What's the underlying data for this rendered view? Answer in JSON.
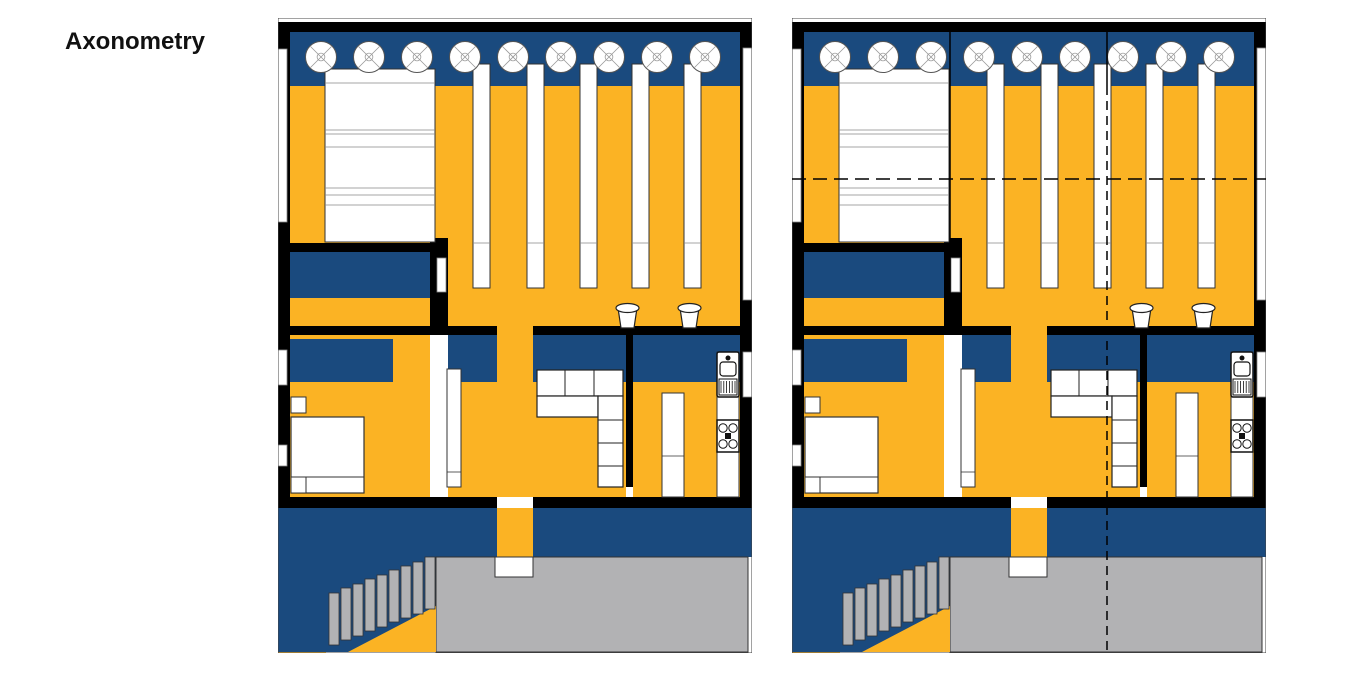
{
  "title": "Axonometry",
  "colors": {
    "navy": "#1A4A7E",
    "yellow": "#FBB324",
    "gray": "#B2B2B4",
    "black": "#000000",
    "white": "#FFFFFF"
  },
  "canvas": {
    "width": 1360,
    "height": 680
  },
  "plan_size": {
    "w": 474,
    "h": 635
  },
  "plans": [
    {
      "id": "floor-plan-left",
      "x": 278,
      "y": 18,
      "overlays": false
    },
    {
      "id": "floor-plan-right",
      "x": 792,
      "y": 18,
      "overlays": true
    }
  ],
  "plan_elements": [
    {
      "name": "hall-floor",
      "kind": "rect",
      "x": 12,
      "y": 68,
      "w": 450,
      "h": 240,
      "fill": "yellow"
    },
    {
      "name": "bedroom-floor",
      "kind": "rect",
      "x": 12,
      "y": 280,
      "w": 140,
      "h": 199,
      "fill": "yellow"
    },
    {
      "name": "living-floor",
      "kind": "rect",
      "x": 170,
      "y": 364,
      "w": 178,
      "h": 115,
      "fill": "yellow"
    },
    {
      "name": "kitchen-floor",
      "kind": "rect",
      "x": 355,
      "y": 364,
      "w": 107,
      "h": 115,
      "fill": "yellow"
    },
    {
      "name": "court-floor",
      "kind": "rect",
      "x": 0,
      "y": 577,
      "w": 48,
      "h": 58,
      "fill": "yellow"
    },
    {
      "name": "gallery-band",
      "kind": "rect",
      "x": 12,
      "y": 14,
      "w": 452,
      "h": 54,
      "fill": "navy"
    },
    {
      "name": "wardrobe-unit",
      "kind": "rect",
      "x": 12,
      "y": 234,
      "w": 145,
      "h": 46,
      "fill": "navy"
    },
    {
      "name": "bedhead-band",
      "kind": "rect",
      "x": 12,
      "y": 321,
      "w": 103,
      "h": 43,
      "fill": "navy"
    },
    {
      "name": "hall-band-left",
      "kind": "rect",
      "x": 170,
      "y": 317,
      "w": 49,
      "h": 47,
      "fill": "navy"
    },
    {
      "name": "hall-band-right",
      "kind": "rect",
      "x": 255,
      "y": 317,
      "w": 93,
      "h": 47,
      "fill": "navy"
    },
    {
      "name": "kitchen-band",
      "kind": "rect",
      "x": 355,
      "y": 317,
      "w": 107,
      "h": 47,
      "fill": "navy"
    },
    {
      "name": "lower-band",
      "kind": "rect",
      "x": 0,
      "y": 490,
      "w": 474,
      "h": 49,
      "fill": "navy"
    },
    {
      "name": "stair-zone",
      "kind": "rect",
      "x": 0,
      "y": 539,
      "w": 158,
      "h": 95,
      "fill": "navy"
    },
    {
      "name": "terrace-slab",
      "kind": "rect",
      "x": 158,
      "y": 539,
      "w": 312,
      "h": 95,
      "fill": "gray",
      "stroke": "#333333",
      "sw": 1
    },
    {
      "name": "corridor-floor",
      "kind": "rect",
      "x": 219,
      "y": 270,
      "w": 36,
      "h": 209,
      "fill": "yellow"
    },
    {
      "name": "corridor-lower",
      "kind": "rect",
      "x": 219,
      "y": 490,
      "w": 36,
      "h": 49,
      "fill": "yellow"
    },
    {
      "name": "under-stair-wedge",
      "kind": "polygon",
      "pts": [
        [
          70,
          634
        ],
        [
          158,
          634
        ],
        [
          158,
          588
        ]
      ],
      "fill": "yellow"
    },
    {
      "name": "stair-step",
      "kind": "rect",
      "x": 51,
      "y": 575,
      "w": 10,
      "h": 52,
      "fill": "gray",
      "stroke": "#333333",
      "sw": 0.8
    },
    {
      "name": "stair-step",
      "kind": "rect",
      "x": 63,
      "y": 570,
      "w": 10,
      "h": 52,
      "fill": "gray",
      "stroke": "#333333",
      "sw": 0.8
    },
    {
      "name": "stair-step",
      "kind": "rect",
      "x": 75,
      "y": 566,
      "w": 10,
      "h": 52,
      "fill": "gray",
      "stroke": "#333333",
      "sw": 0.8
    },
    {
      "name": "stair-step",
      "kind": "rect",
      "x": 87,
      "y": 561,
      "w": 10,
      "h": 52,
      "fill": "gray",
      "stroke": "#333333",
      "sw": 0.8
    },
    {
      "name": "stair-step",
      "kind": "rect",
      "x": 99,
      "y": 557,
      "w": 10,
      "h": 52,
      "fill": "gray",
      "stroke": "#333333",
      "sw": 0.8
    },
    {
      "name": "stair-step",
      "kind": "rect",
      "x": 111,
      "y": 552,
      "w": 10,
      "h": 52,
      "fill": "gray",
      "stroke": "#333333",
      "sw": 0.8
    },
    {
      "name": "stair-step",
      "kind": "rect",
      "x": 123,
      "y": 548,
      "w": 10,
      "h": 52,
      "fill": "gray",
      "stroke": "#333333",
      "sw": 0.8
    },
    {
      "name": "stair-step",
      "kind": "rect",
      "x": 135,
      "y": 544,
      "w": 10,
      "h": 52,
      "fill": "gray",
      "stroke": "#333333",
      "sw": 0.8
    },
    {
      "name": "stair-step",
      "kind": "rect",
      "x": 147,
      "y": 539,
      "w": 10,
      "h": 52,
      "fill": "gray",
      "stroke": "#333333",
      "sw": 0.8
    },
    {
      "name": "top-wall",
      "kind": "rect",
      "x": 3,
      "y": 4,
      "w": 468,
      "h": 10,
      "fill": "black"
    },
    {
      "name": "left-wall",
      "kind": "rect",
      "x": 0,
      "y": 4,
      "w": 12,
      "h": 486,
      "fill": "black"
    },
    {
      "name": "right-wall",
      "kind": "rect",
      "x": 462,
      "y": 4,
      "w": 12,
      "h": 486,
      "fill": "black"
    },
    {
      "name": "wall-bed-hall-h",
      "kind": "rect",
      "x": 0,
      "y": 225,
      "w": 170,
      "h": 9,
      "fill": "black"
    },
    {
      "name": "wall-bed-hall-v",
      "kind": "rect",
      "x": 152,
      "y": 220,
      "w": 18,
      "h": 95,
      "fill": "black"
    },
    {
      "name": "wall-mid-left",
      "kind": "rect",
      "x": 0,
      "y": 308,
      "w": 219,
      "h": 9,
      "fill": "black"
    },
    {
      "name": "wall-mid-right",
      "kind": "rect",
      "x": 255,
      "y": 308,
      "w": 219,
      "h": 9,
      "fill": "black"
    },
    {
      "name": "wall-living-kitchen",
      "kind": "rect",
      "x": 348,
      "y": 317,
      "w": 7,
      "h": 152,
      "fill": "black"
    },
    {
      "name": "wall-bottom-left",
      "kind": "rect",
      "x": 0,
      "y": 479,
      "w": 219,
      "h": 11,
      "fill": "black"
    },
    {
      "name": "wall-bottom-right",
      "kind": "rect",
      "x": 255,
      "y": 479,
      "w": 219,
      "h": 11,
      "fill": "black"
    },
    {
      "name": "window-left-upper",
      "kind": "rect",
      "x": 0,
      "y": 31,
      "w": 9,
      "h": 173,
      "fill": "white",
      "stroke": "#888888",
      "sw": 0.8
    },
    {
      "name": "window-left-mid",
      "kind": "rect",
      "x": 0,
      "y": 332,
      "w": 9,
      "h": 35,
      "fill": "white",
      "stroke": "#888888",
      "sw": 0.8
    },
    {
      "name": "window-left-lower",
      "kind": "rect",
      "x": 0,
      "y": 427,
      "w": 9,
      "h": 21,
      "fill": "white",
      "stroke": "#888888",
      "sw": 0.8
    },
    {
      "name": "window-right-upper",
      "kind": "rect",
      "x": 465,
      "y": 30,
      "w": 9,
      "h": 252,
      "fill": "white",
      "stroke": "#888888",
      "sw": 0.8
    },
    {
      "name": "window-right-sink",
      "kind": "rect",
      "x": 465,
      "y": 334,
      "w": 9,
      "h": 45,
      "fill": "white",
      "stroke": "#888888",
      "sw": 0.8
    },
    {
      "name": "door-wardrobe",
      "kind": "rect",
      "x": 159,
      "y": 240,
      "w": 9,
      "h": 34,
      "fill": "white",
      "stroke": "#888888",
      "sw": 0.8
    },
    {
      "name": "tatami-bed",
      "kind": "rect",
      "x": 47,
      "y": 51,
      "w": 110,
      "h": 173,
      "fill": "white",
      "stroke": "#333333",
      "sw": 1
    },
    {
      "name": "tatami-line",
      "kind": "line",
      "x1": 47,
      "y1": 65,
      "x2": 157,
      "y2": 65,
      "stroke": "#888888",
      "sw": 0.8
    },
    {
      "name": "tatami-line",
      "kind": "line",
      "x1": 47,
      "y1": 112,
      "x2": 157,
      "y2": 112,
      "stroke": "#888888",
      "sw": 0.8
    },
    {
      "name": "tatami-line",
      "kind": "line",
      "x1": 47,
      "y1": 116,
      "x2": 157,
      "y2": 116,
      "stroke": "#888888",
      "sw": 0.8
    },
    {
      "name": "tatami-line",
      "kind": "line",
      "x1": 47,
      "y1": 129,
      "x2": 157,
      "y2": 129,
      "stroke": "#888888",
      "sw": 0.8
    },
    {
      "name": "tatami-line",
      "kind": "line",
      "x1": 47,
      "y1": 170,
      "x2": 157,
      "y2": 170,
      "stroke": "#888888",
      "sw": 0.8
    },
    {
      "name": "tatami-line",
      "kind": "line",
      "x1": 47,
      "y1": 177,
      "x2": 157,
      "y2": 177,
      "stroke": "#888888",
      "sw": 0.8
    },
    {
      "name": "tatami-line",
      "kind": "line",
      "x1": 47,
      "y1": 187,
      "x2": 157,
      "y2": 187,
      "stroke": "#888888",
      "sw": 0.8
    },
    {
      "name": "shelf-bar",
      "kind": "rect",
      "x": 195,
      "y": 46,
      "w": 17,
      "h": 224,
      "fill": "white",
      "stroke": "#333333",
      "sw": 1
    },
    {
      "name": "shelf-bar",
      "kind": "rect",
      "x": 249,
      "y": 46,
      "w": 17,
      "h": 224,
      "fill": "white",
      "stroke": "#333333",
      "sw": 1
    },
    {
      "name": "shelf-bar",
      "kind": "rect",
      "x": 302,
      "y": 46,
      "w": 17,
      "h": 224,
      "fill": "white",
      "stroke": "#333333",
      "sw": 1
    },
    {
      "name": "shelf-bar",
      "kind": "rect",
      "x": 354,
      "y": 46,
      "w": 17,
      "h": 224,
      "fill": "white",
      "stroke": "#333333",
      "sw": 1
    },
    {
      "name": "shelf-bar",
      "kind": "rect",
      "x": 406,
      "y": 46,
      "w": 17,
      "h": 224,
      "fill": "white",
      "stroke": "#333333",
      "sw": 1
    },
    {
      "name": "shelf-line",
      "kind": "line",
      "x1": 195,
      "y1": 225,
      "x2": 212,
      "y2": 225,
      "stroke": "#888888",
      "sw": 0.8
    },
    {
      "name": "shelf-line",
      "kind": "line",
      "x1": 249,
      "y1": 225,
      "x2": 266,
      "y2": 225,
      "stroke": "#888888",
      "sw": 0.8
    },
    {
      "name": "shelf-line",
      "kind": "line",
      "x1": 302,
      "y1": 225,
      "x2": 319,
      "y2": 225,
      "stroke": "#888888",
      "sw": 0.8
    },
    {
      "name": "shelf-line",
      "kind": "line",
      "x1": 354,
      "y1": 225,
      "x2": 371,
      "y2": 225,
      "stroke": "#888888",
      "sw": 0.8
    },
    {
      "name": "shelf-line",
      "kind": "line",
      "x1": 406,
      "y1": 225,
      "x2": 423,
      "y2": 225,
      "stroke": "#888888",
      "sw": 0.8
    },
    {
      "name": "skylight",
      "kind": "skylight",
      "cx": 43,
      "cy": 39,
      "r": 15.5
    },
    {
      "name": "skylight",
      "kind": "skylight",
      "cx": 91,
      "cy": 39,
      "r": 15.5
    },
    {
      "name": "skylight",
      "kind": "skylight",
      "cx": 139,
      "cy": 39,
      "r": 15.5
    },
    {
      "name": "skylight",
      "kind": "skylight",
      "cx": 187,
      "cy": 39,
      "r": 15.5
    },
    {
      "name": "skylight",
      "kind": "skylight",
      "cx": 235,
      "cy": 39,
      "r": 15.5
    },
    {
      "name": "skylight",
      "kind": "skylight",
      "cx": 283,
      "cy": 39,
      "r": 15.5
    },
    {
      "name": "skylight",
      "kind": "skylight",
      "cx": 331,
      "cy": 39,
      "r": 15.5
    },
    {
      "name": "skylight",
      "kind": "skylight",
      "cx": 379,
      "cy": 39,
      "r": 15.5
    },
    {
      "name": "skylight",
      "kind": "skylight",
      "cx": 427,
      "cy": 39,
      "r": 15.5
    },
    {
      "name": "door-leaf",
      "kind": "rect",
      "x": 169,
      "y": 351,
      "w": 14,
      "h": 118,
      "fill": "white",
      "stroke": "#333333",
      "sw": 1
    },
    {
      "name": "door-leaf-line",
      "kind": "line",
      "x1": 169,
      "y1": 454,
      "x2": 183,
      "y2": 454,
      "stroke": "#333333",
      "sw": 0.8
    },
    {
      "name": "stool",
      "kind": "stool",
      "x": 337,
      "y": 285,
      "w": 25,
      "h": 25
    },
    {
      "name": "stool",
      "kind": "stool",
      "x": 399,
      "y": 285,
      "w": 25,
      "h": 25
    },
    {
      "name": "sofa-back",
      "kind": "rect",
      "x": 259,
      "y": 352,
      "w": 86,
      "h": 26,
      "fill": "white",
      "stroke": "#222222",
      "sw": 1.2
    },
    {
      "name": "sofa-back-line",
      "kind": "line",
      "x1": 287,
      "y1": 352,
      "x2": 287,
      "y2": 378,
      "stroke": "#222222",
      "sw": 1
    },
    {
      "name": "sofa-back-line",
      "kind": "line",
      "x1": 316,
      "y1": 352,
      "x2": 316,
      "y2": 378,
      "stroke": "#222222",
      "sw": 1
    },
    {
      "name": "sofa-seat",
      "kind": "rect",
      "x": 259,
      "y": 378,
      "w": 61,
      "h": 21,
      "fill": "white",
      "stroke": "#222222",
      "sw": 1.2
    },
    {
      "name": "sofa-arm",
      "kind": "rect",
      "x": 320,
      "y": 378,
      "w": 25,
      "h": 91,
      "fill": "white",
      "stroke": "#222222",
      "sw": 1.2
    },
    {
      "name": "sofa-arm-line",
      "kind": "line",
      "x1": 320,
      "y1": 402,
      "x2": 345,
      "y2": 402,
      "stroke": "#222222",
      "sw": 1
    },
    {
      "name": "sofa-arm-line",
      "kind": "line",
      "x1": 320,
      "y1": 425,
      "x2": 345,
      "y2": 425,
      "stroke": "#222222",
      "sw": 1
    },
    {
      "name": "sofa-arm-line",
      "kind": "line",
      "x1": 320,
      "y1": 448,
      "x2": 345,
      "y2": 448,
      "stroke": "#222222",
      "sw": 1
    },
    {
      "name": "kitchen-counter",
      "kind": "rect",
      "x": 439,
      "y": 334,
      "w": 22,
      "h": 145,
      "fill": "white",
      "stroke": "#333333",
      "sw": 1
    },
    {
      "name": "kitchen-sink",
      "kind": "sink",
      "x": 439,
      "y": 334,
      "w": 22,
      "h": 45
    },
    {
      "name": "kitchen-stove",
      "kind": "stove",
      "x": 439,
      "y": 402,
      "w": 22,
      "h": 32
    },
    {
      "name": "tall-cabinet",
      "kind": "rect",
      "x": 384,
      "y": 375,
      "w": 22,
      "h": 104,
      "fill": "white",
      "stroke": "#333333",
      "sw": 1
    },
    {
      "name": "cabinet-line",
      "kind": "line",
      "x1": 384,
      "y1": 438,
      "x2": 406,
      "y2": 438,
      "stroke": "#333333",
      "sw": 0.8
    },
    {
      "name": "nightstand",
      "kind": "rect",
      "x": 13,
      "y": 379,
      "w": 15,
      "h": 16,
      "fill": "white",
      "stroke": "#333333",
      "sw": 1
    },
    {
      "name": "bed",
      "kind": "rect",
      "x": 13,
      "y": 399,
      "w": 73,
      "h": 76,
      "fill": "white",
      "stroke": "#333333",
      "sw": 1.2
    },
    {
      "name": "bed-foot-line",
      "kind": "line",
      "x1": 13,
      "y1": 459,
      "x2": 86,
      "y2": 459,
      "stroke": "#333333",
      "sw": 1
    },
    {
      "name": "nightstand",
      "kind": "rect",
      "x": 13,
      "y": 459,
      "w": 15,
      "h": 16,
      "fill": "white",
      "stroke": "#333333",
      "sw": 1
    },
    {
      "name": "doormat",
      "kind": "rect",
      "x": 217,
      "y": 539,
      "w": 38,
      "h": 20,
      "fill": "white",
      "stroke": "#333333",
      "sw": 1
    },
    {
      "name": "plan-outline",
      "kind": "rect",
      "x": 0,
      "y": 0,
      "w": 474,
      "h": 635,
      "fill": "none",
      "stroke": "#444444",
      "sw": 1
    }
  ],
  "overlay_elements": [
    {
      "name": "module-line-a",
      "kind": "line",
      "x1": 158,
      "y1": 14,
      "x2": 158,
      "y2": 308,
      "stroke": "black",
      "sw": 1.5
    },
    {
      "name": "module-line-b-top",
      "kind": "line",
      "x1": 315,
      "y1": 14,
      "x2": 315,
      "y2": 68,
      "stroke": "black",
      "sw": 1.5
    },
    {
      "name": "section-line-v",
      "kind": "line",
      "x1": 315,
      "y1": 68,
      "x2": 315,
      "y2": 634,
      "stroke": "black",
      "sw": 1.5,
      "dash": "9,6"
    },
    {
      "name": "section-line-h",
      "kind": "line",
      "x1": 0,
      "y1": 161,
      "x2": 474,
      "y2": 161,
      "stroke": "black",
      "sw": 1.5,
      "dash": "14,7"
    }
  ]
}
